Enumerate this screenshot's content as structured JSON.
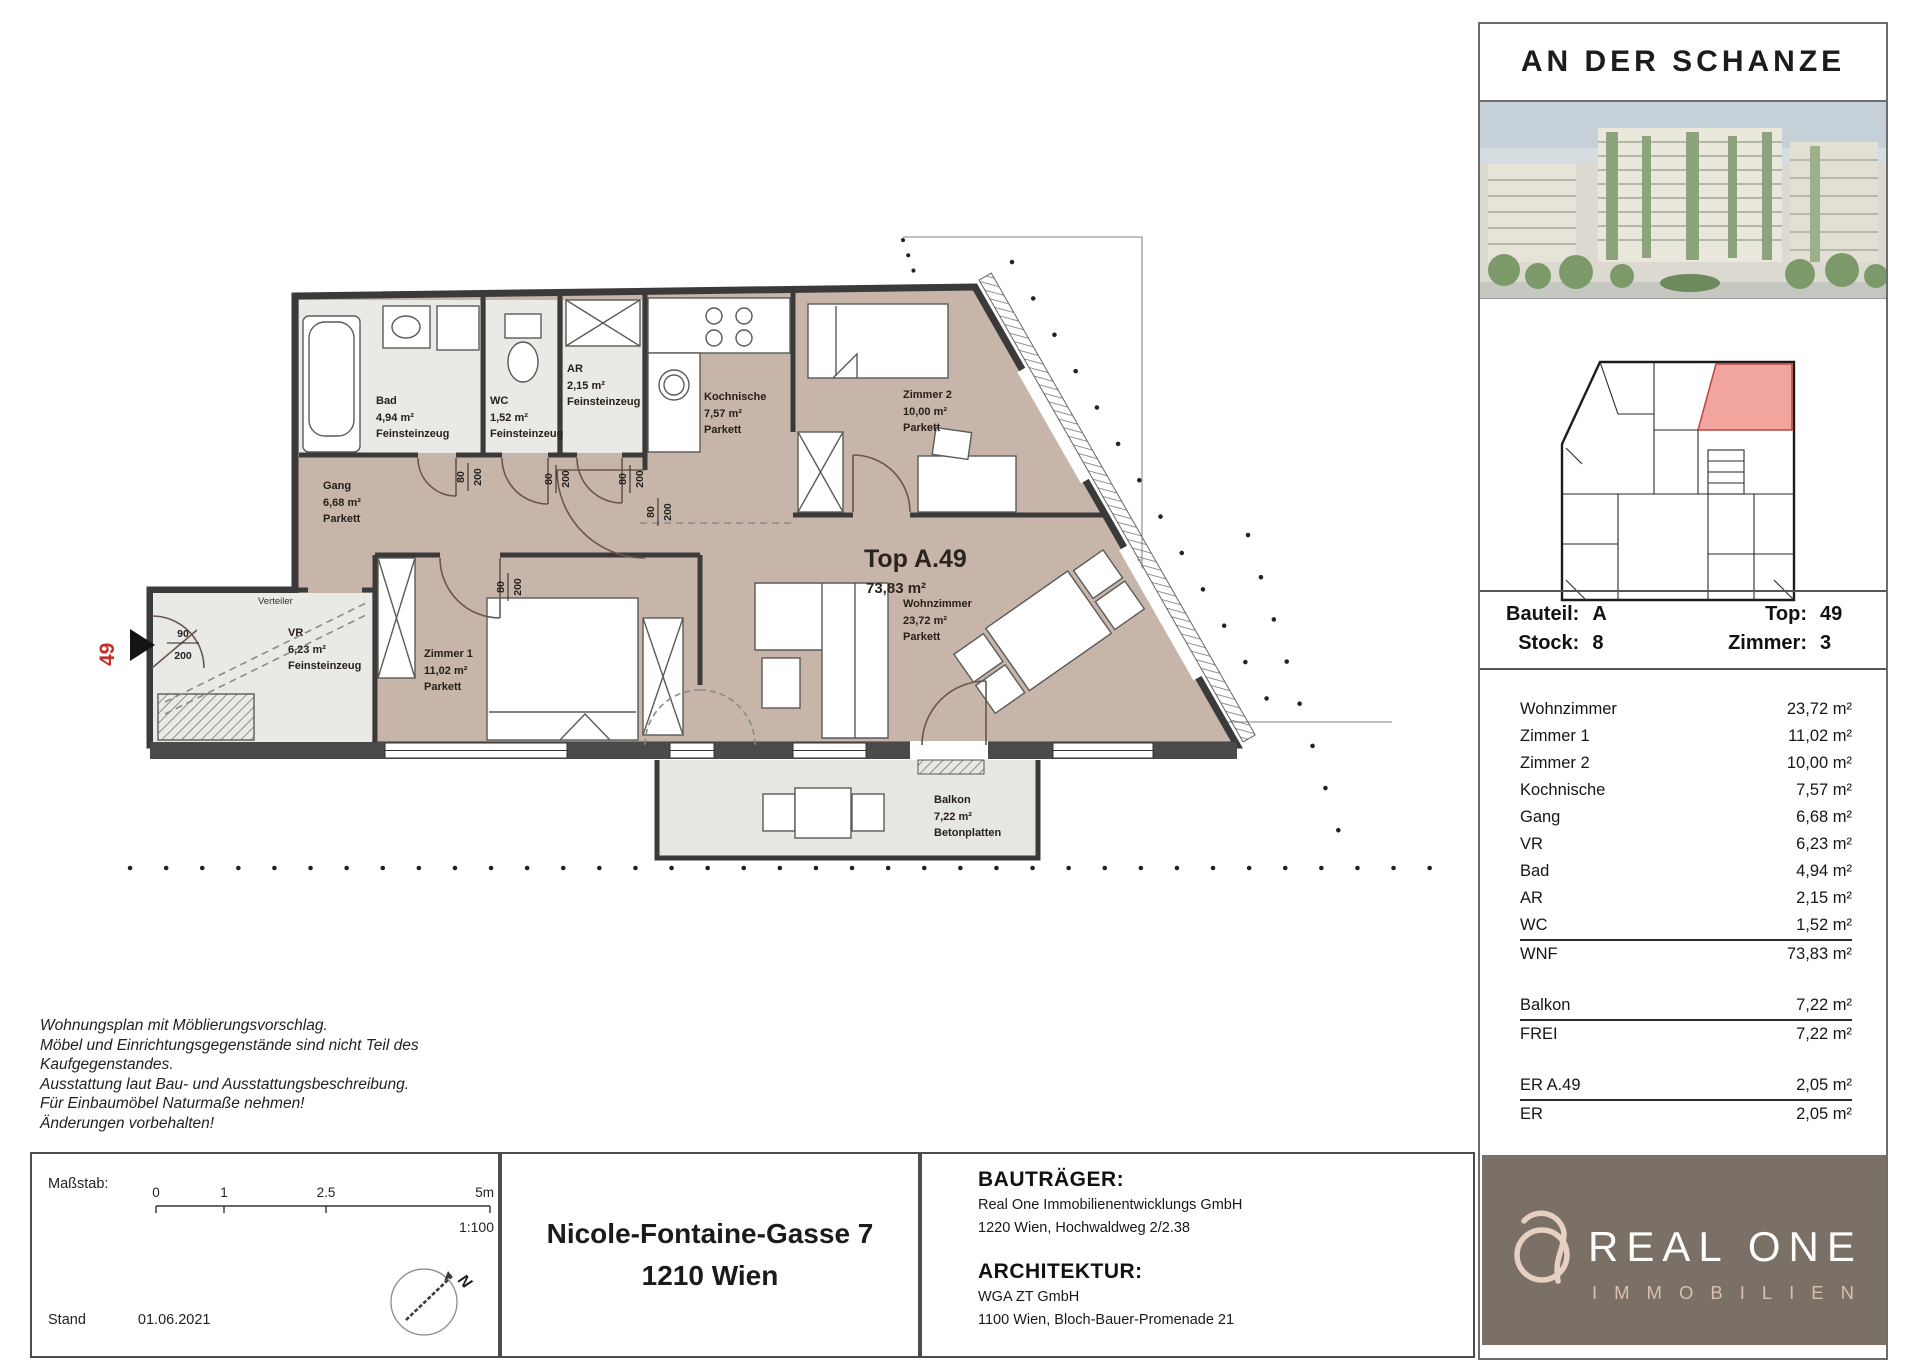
{
  "sidebar": {
    "title": "AN DER SCHANZE",
    "unit": {
      "bauteil_label": "Bauteil:",
      "bauteil_value": "A",
      "stock_label": "Stock:",
      "stock_value": "8",
      "top_label": "Top:",
      "top_value": "49",
      "zimmer_label": "Zimmer:",
      "zimmer_value": "3"
    },
    "table": {
      "rows": [
        {
          "name": "Wohnzimmer",
          "value": "23,72 m²"
        },
        {
          "name": "Zimmer 1",
          "value": "11,02 m²"
        },
        {
          "name": "Zimmer 2",
          "value": "10,00 m²"
        },
        {
          "name": "Kochnische",
          "value": "7,57 m²"
        },
        {
          "name": "Gang",
          "value": "6,68 m²"
        },
        {
          "name": "VR",
          "value": "6,23 m²"
        },
        {
          "name": "Bad",
          "value": "4,94 m²"
        },
        {
          "name": "AR",
          "value": "2,15 m²"
        },
        {
          "name": "WC",
          "value": "1,52 m²"
        }
      ],
      "wnf": {
        "name": "WNF",
        "value": "73,83 m²"
      },
      "balkon": {
        "name": "Balkon",
        "value": "7,22 m²"
      },
      "frei": {
        "name": "FREI",
        "value": "7,22 m²"
      },
      "er_a49": {
        "name": "ER A.49",
        "value": "2,05 m²"
      },
      "er": {
        "name": "ER",
        "value": "2,05 m²"
      }
    },
    "logo": {
      "brand": "REAL ONE",
      "subtitle": "IMMOBILIEN"
    }
  },
  "plan": {
    "top_label": {
      "title": "Top A.49",
      "area": "73,83 m²"
    },
    "rooms": {
      "bad": {
        "name": "Bad",
        "area": "4,94 m²",
        "floor": "Feinsteinzeug"
      },
      "wc": {
        "name": "WC",
        "area": "1,52 m²",
        "floor": "Feinsteinzeug"
      },
      "ar": {
        "name": "AR",
        "area": "2,15 m²",
        "floor": "Feinsteinzeug"
      },
      "kochnische": {
        "name": "Kochnische",
        "area": "7,57 m²",
        "floor": "Parkett"
      },
      "zimmer2": {
        "name": "Zimmer 2",
        "area": "10,00 m²",
        "floor": "Parkett"
      },
      "gang": {
        "name": "Gang",
        "area": "6,68 m²",
        "floor": "Parkett"
      },
      "vr": {
        "name": "VR",
        "area": "6,23 m²",
        "floor": "Feinsteinzeug"
      },
      "zimmer1": {
        "name": "Zimmer 1",
        "area": "11,02 m²",
        "floor": "Parkett"
      },
      "wohnzimmer": {
        "name": "Wohnzimmer",
        "area": "23,72 m²",
        "floor": "Parkett"
      },
      "balkon": {
        "name": "Balkon",
        "area": "7,22 m²",
        "floor": "Betonplatten"
      }
    },
    "doors": {
      "d80": "80",
      "d90": "90",
      "d200": "200"
    },
    "entrance_number": "49",
    "verteiler_label": "Verteiler"
  },
  "footer": {
    "disclaimer": [
      "Wohnungsplan mit Möblierungsvorschlag.",
      "Möbel und Einrichtungsgegenstände sind nicht Teil des",
      "Kaufgegenstandes.",
      "Ausstattung laut Bau- und Ausstattungsbeschreibung.",
      "Für Einbaumöbel Naturmaße nehmen!",
      "Änderungen vorbehalten!"
    ],
    "scale": {
      "label": "Maßstab:",
      "ticks": [
        "0",
        "1",
        "2.5",
        "5m"
      ],
      "ratio": "1:100",
      "stand_label": "Stand",
      "stand_value": "01.06.2021",
      "north": "N"
    },
    "address": {
      "line1": "Nicole-Fontaine-Gasse 7",
      "line2": "1210 Wien"
    },
    "developer": {
      "heading": "BAUTRÄGER:",
      "name": "Real One Immobilienentwicklungs GmbH",
      "address": "1220 Wien, Hochwaldweg 2/2.38"
    },
    "architecture": {
      "heading": "ARCHITEKTUR:",
      "name": "WGA ZT GmbH",
      "address": "1100 Wien, Bloch-Bauer-Promenade 21"
    }
  },
  "colors": {
    "parkett": "#c8b5a9",
    "tile": "#e9e9e6",
    "wall": "#3a3a3a",
    "accent_red": "#c2302c",
    "logo_bg": "#7b7065",
    "keyplan_highlight": "#f2a49e"
  }
}
